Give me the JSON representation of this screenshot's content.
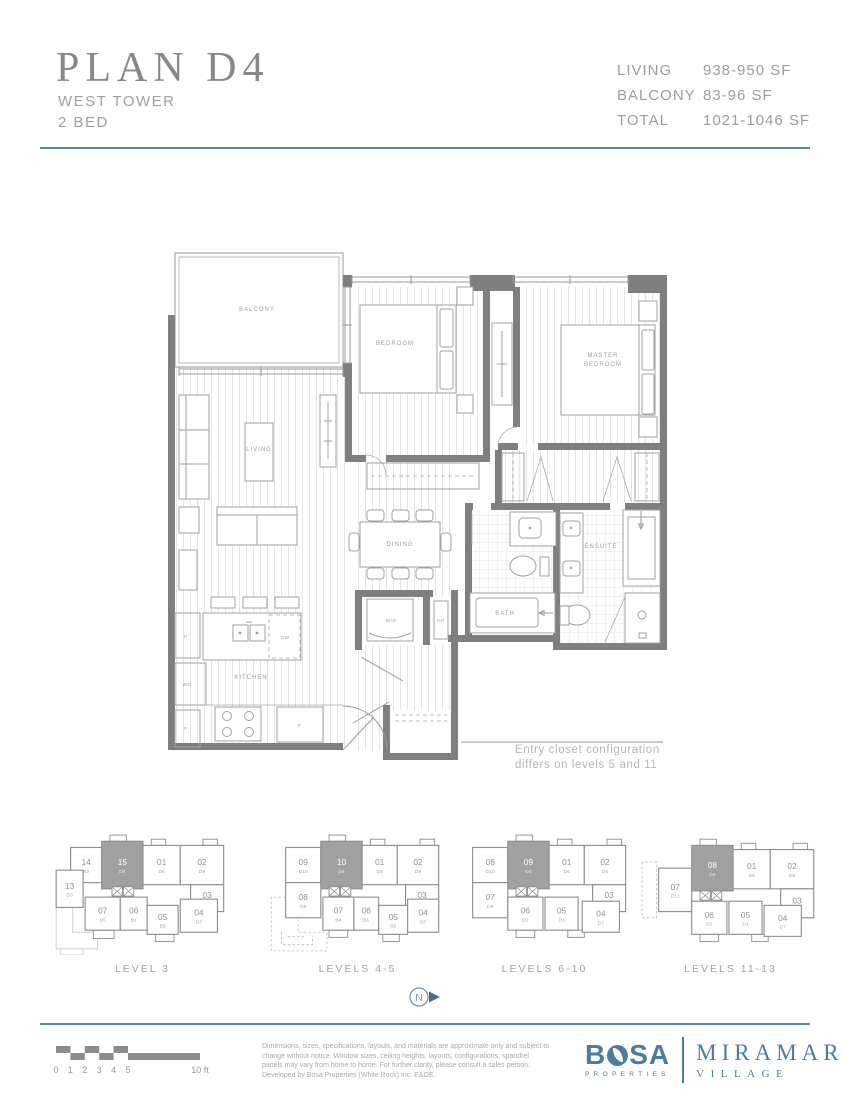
{
  "header": {
    "title": "PLAN D4",
    "subtitle_line1": "WEST TOWER",
    "subtitle_line2": "2 BED",
    "stats": [
      {
        "label": "LIVING",
        "value": "938-950 SF"
      },
      {
        "label": "BALCONY",
        "value": "83-96 SF"
      },
      {
        "label": "TOTAL",
        "value": "1021-1046 SF"
      }
    ],
    "accent_color": "#5b87a3"
  },
  "floorplan": {
    "labels": {
      "balcony": "BALCONY",
      "living": "LIVING",
      "bedroom": "BEDROOM",
      "master_1": "MASTER",
      "master_2": "BEDROOM",
      "dining": "DINING",
      "kitchen": "KITCHEN",
      "wd": "W/D",
      "hp": "HP",
      "bath": "BATH",
      "ensuite": "ENSUITE",
      "wo": "WO",
      "p1": "P",
      "p2": "P",
      "dw": "DW",
      "f": "F"
    },
    "note_line1": "Entry closet configuration",
    "note_line2": "differs on levels 5 and 11"
  },
  "keyplans": [
    {
      "caption": "LEVEL 3",
      "units": [
        {
          "n": "14",
          "t": "B2",
          "x": 18,
          "y": 14,
          "w": 30,
          "h": 34
        },
        {
          "n": "15",
          "t": "D4",
          "x": 48,
          "y": 8,
          "w": 40,
          "h": 46,
          "hl": true
        },
        {
          "n": "01",
          "t": "D6",
          "x": 88,
          "y": 12,
          "w": 36,
          "h": 38
        },
        {
          "n": "02",
          "t": "D9",
          "x": 124,
          "y": 12,
          "w": 42,
          "h": 38
        },
        {
          "n": "13",
          "t": "D3",
          "x": 4,
          "y": 36,
          "w": 26,
          "h": 36
        },
        {
          "n": "03",
          "t": "B3",
          "x": 134,
          "y": 50,
          "w": 32,
          "h": 26
        },
        {
          "n": "07",
          "t": "D5",
          "x": 32,
          "y": 62,
          "w": 34,
          "h": 32
        },
        {
          "n": "06",
          "t": "B1",
          "x": 66,
          "y": 62,
          "w": 26,
          "h": 32
        },
        {
          "n": "05",
          "t": "B5",
          "x": 92,
          "y": 70,
          "w": 30,
          "h": 28
        },
        {
          "n": "04",
          "t": "D7",
          "x": 124,
          "y": 64,
          "w": 36,
          "h": 32
        }
      ],
      "elevators": [
        [
          58,
          52
        ],
        [
          69,
          52
        ]
      ],
      "bumps": [
        [
          56,
          2,
          16,
          6
        ],
        [
          96,
          6,
          14,
          6
        ],
        [
          146,
          6,
          14,
          6
        ],
        [
          40,
          94,
          20,
          8
        ],
        [
          100,
          98,
          18,
          7
        ]
      ],
      "faint": [
        "4,72 4,112 44,112 44,96 20,96 20,72",
        "8,112 8,118 30,118 30,112"
      ],
      "dashed": []
    },
    {
      "caption": "LEVELS 4-5",
      "units": [
        {
          "n": "09",
          "t": "D10",
          "x": 18,
          "y": 14,
          "w": 34,
          "h": 34
        },
        {
          "n": "10",
          "t": "D4",
          "x": 52,
          "y": 8,
          "w": 40,
          "h": 46,
          "hl": true
        },
        {
          "n": "01",
          "t": "D6",
          "x": 92,
          "y": 12,
          "w": 34,
          "h": 38
        },
        {
          "n": "02",
          "t": "D9",
          "x": 126,
          "y": 12,
          "w": 40,
          "h": 38
        },
        {
          "n": "08",
          "t": "D8",
          "x": 18,
          "y": 48,
          "w": 34,
          "h": 34
        },
        {
          "n": "03",
          "t": "B3",
          "x": 134,
          "y": 50,
          "w": 32,
          "h": 26
        },
        {
          "n": "07",
          "t": "B4",
          "x": 54,
          "y": 62,
          "w": 30,
          "h": 32
        },
        {
          "n": "06",
          "t": "B1",
          "x": 84,
          "y": 62,
          "w": 24,
          "h": 32
        },
        {
          "n": "05",
          "t": "B5",
          "x": 108,
          "y": 70,
          "w": 28,
          "h": 28
        },
        {
          "n": "04",
          "t": "D7",
          "x": 136,
          "y": 64,
          "w": 30,
          "h": 32
        }
      ],
      "elevators": [
        [
          60,
          52
        ],
        [
          71,
          52
        ]
      ],
      "bumps": [
        [
          60,
          2,
          16,
          6
        ],
        [
          100,
          6,
          14,
          6
        ],
        [
          148,
          6,
          14,
          6
        ],
        [
          60,
          94,
          18,
          7
        ],
        [
          112,
          98,
          16,
          7
        ]
      ],
      "faint": [],
      "dashed": [
        "4,62 4,114 58,114 58,96 30,96 30,62 4,62",
        "14,96 14,108 44,108 44,100",
        "20,100 36,100"
      ]
    },
    {
      "caption": "LEVELS 6-10",
      "units": [
        {
          "n": "08",
          "t": "D10",
          "x": 18,
          "y": 14,
          "w": 34,
          "h": 34
        },
        {
          "n": "09",
          "t": "D4",
          "x": 52,
          "y": 8,
          "w": 40,
          "h": 46,
          "hl": true
        },
        {
          "n": "01",
          "t": "D6",
          "x": 92,
          "y": 12,
          "w": 34,
          "h": 38
        },
        {
          "n": "02",
          "t": "D9",
          "x": 126,
          "y": 12,
          "w": 40,
          "h": 38
        },
        {
          "n": "07",
          "t": "D8",
          "x": 18,
          "y": 48,
          "w": 34,
          "h": 34
        },
        {
          "n": "03",
          "t": "B3",
          "x": 134,
          "y": 50,
          "w": 32,
          "h": 26
        },
        {
          "n": "06",
          "t": "D2",
          "x": 52,
          "y": 62,
          "w": 34,
          "h": 32
        },
        {
          "n": "05",
          "t": "D1",
          "x": 88,
          "y": 62,
          "w": 32,
          "h": 32
        },
        {
          "n": "04",
          "t": "D7",
          "x": 124,
          "y": 66,
          "w": 36,
          "h": 30
        }
      ],
      "elevators": [
        [
          60,
          52
        ],
        [
          71,
          52
        ]
      ],
      "bumps": [
        [
          60,
          2,
          16,
          6
        ],
        [
          100,
          6,
          14,
          6
        ],
        [
          148,
          6,
          14,
          6
        ],
        [
          60,
          94,
          18,
          7
        ],
        [
          110,
          94,
          16,
          7
        ]
      ],
      "faint": [],
      "dashed": []
    },
    {
      "caption": "LEVELS 11-13",
      "units": [
        {
          "n": "07",
          "t": "D12",
          "x": 18,
          "y": 34,
          "w": 32,
          "h": 42
        },
        {
          "n": "08",
          "t": "D4",
          "x": 50,
          "y": 12,
          "w": 40,
          "h": 44,
          "hl": true
        },
        {
          "n": "01",
          "t": "D6",
          "x": 90,
          "y": 16,
          "w": 36,
          "h": 38
        },
        {
          "n": "02",
          "t": "D9",
          "x": 126,
          "y": 16,
          "w": 42,
          "h": 38
        },
        {
          "n": "03",
          "t": "B3",
          "x": 136,
          "y": 54,
          "w": 32,
          "h": 28
        },
        {
          "n": "06",
          "t": "D2",
          "x": 50,
          "y": 66,
          "w": 34,
          "h": 32
        },
        {
          "n": "05",
          "t": "D1",
          "x": 86,
          "y": 66,
          "w": 32,
          "h": 32
        },
        {
          "n": "04",
          "t": "D7",
          "x": 120,
          "y": 70,
          "w": 36,
          "h": 30
        }
      ],
      "elevators": [
        [
          58,
          56
        ],
        [
          69,
          56
        ]
      ],
      "bumps": [
        [
          58,
          6,
          16,
          6
        ],
        [
          98,
          10,
          14,
          6
        ],
        [
          148,
          10,
          14,
          6
        ],
        [
          58,
          98,
          18,
          7
        ],
        [
          108,
          98,
          16,
          7
        ]
      ],
      "faint": [],
      "dashed": [
        "2,28 2,82 16,82 16,28 2,28"
      ]
    }
  ],
  "north": {
    "label": "N"
  },
  "footer": {
    "scale": {
      "ticks": [
        "0",
        "1",
        "2",
        "3",
        "4",
        "5"
      ],
      "end_label": "10 ft"
    },
    "disclaimer": "Dimensions, sizes, specifications, layouts, and materials are approximate only and subject to change without notice. Window sizes, ceiling heights, layouts, configurations, spandrel panels may vary from home to home. For further clarity, please consult a sales person. Developed by Bosa Properties (White Rock) Inc. E&OE.",
    "logo": {
      "bosa_b": "B",
      "bosa_sa": "SA",
      "properties": "PROPERTIES",
      "miramar": "MIRAMAR",
      "village": "VILLAGE",
      "color": "#4d7d9b"
    }
  }
}
